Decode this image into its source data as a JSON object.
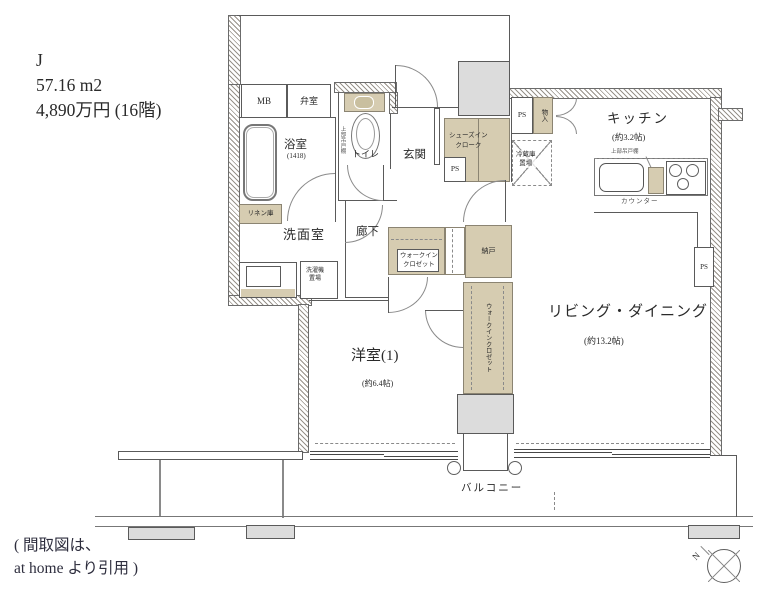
{
  "header": {
    "unit_type": "J",
    "area": "57.16 m2",
    "price": "4,890万円 (16階)"
  },
  "plan": {
    "labels": {
      "mb": "MB",
      "benshitsu": "弁室",
      "bathroom": "浴室",
      "bathroom_size": "(1418)",
      "toilet": "トイレ",
      "toilet_shelf": "上部吊戸棚",
      "linen": "リネン庫",
      "powder_room": "洗面室",
      "washer_line1": "洗濯機",
      "washer_line2": "置場",
      "hallway": "廊下",
      "entrance": "玄関",
      "sic_line1": "シューズイン",
      "sic_line2": "クローク",
      "ps": "PS",
      "closet": "物入",
      "fridge_line1": "冷蔵庫",
      "fridge_line2": "置場",
      "kitchen": "キッチン",
      "kitchen_size": "(約3.2帖)",
      "kitchen_shelf": "上部吊戸棚",
      "counter": "カウンター",
      "wic_line1": "ウォークイン",
      "wic_line2": "クロゼット",
      "nando": "納戸",
      "wic_vertical": "ウォークインクロゼット",
      "living": "リビング・ダイニング",
      "living_size": "(約13.2帖)",
      "bedroom": "洋室(1)",
      "bedroom_size": "(約6.4帖)",
      "balcony": "バルコニー"
    },
    "colors": {
      "storage_fill": "#d6ccb1",
      "structure_fill": "#dcdcdc",
      "wall_line": "#6b6b6b"
    }
  },
  "footer": {
    "citation_line1": "( 間取図は、",
    "citation_line2": "at home より引用 )"
  },
  "compass": {
    "north": "N"
  }
}
